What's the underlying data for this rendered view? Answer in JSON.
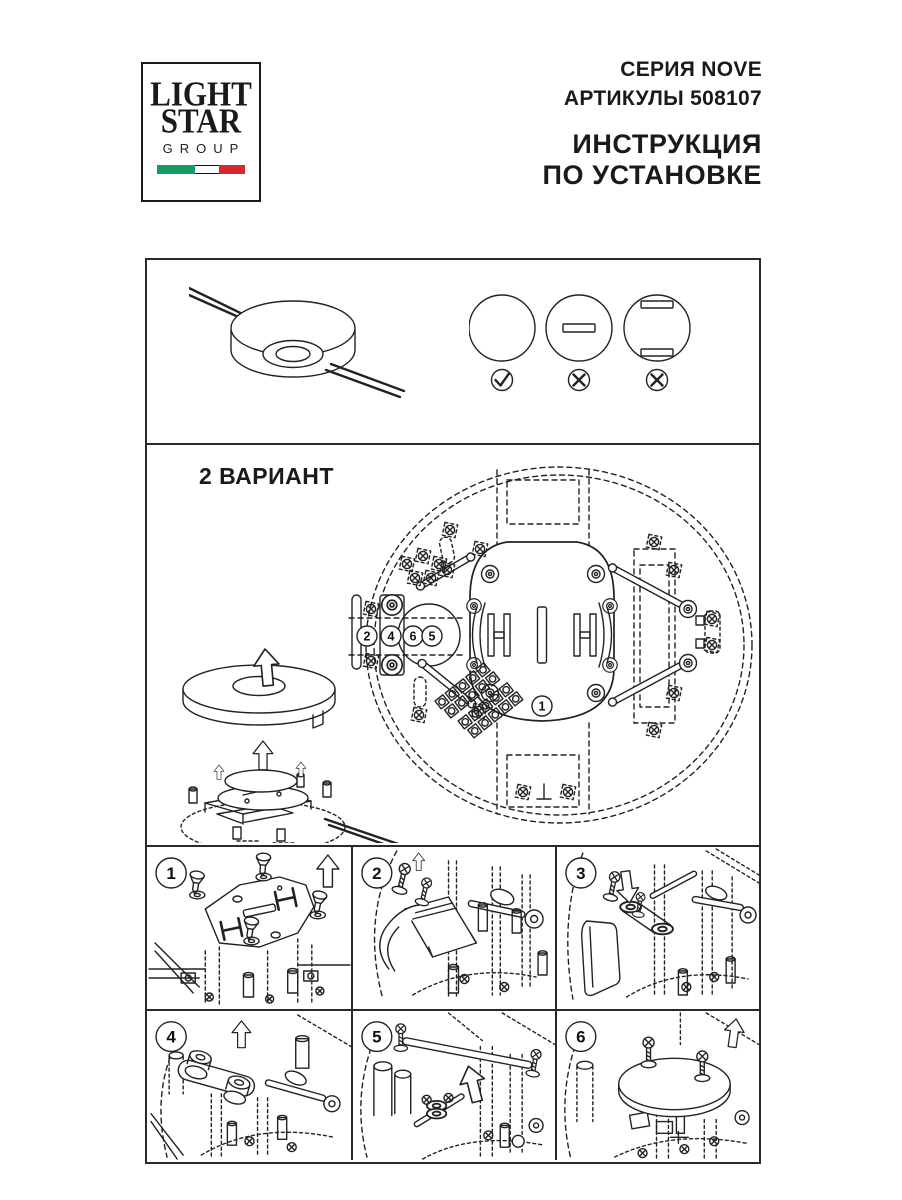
{
  "logo": {
    "line1": "LIGHT",
    "line2": "STAR",
    "line3": "GROUP"
  },
  "header": {
    "series": "СЕРИЯ NOVE",
    "articles": "АРТИКУЛЫ 508107",
    "title_line1": "ИНСТРУКЦИЯ",
    "title_line2": "ПО УСТАНОВКЕ"
  },
  "symbols": {
    "ok_mark": "✓",
    "wrong_mark": "✕"
  },
  "variant": {
    "heading": "2 ВАРИАНТ",
    "callouts": [
      "2",
      "4",
      "6",
      "5"
    ],
    "plate_callout": "1"
  },
  "steps": [
    {
      "number": "1"
    },
    {
      "number": "2"
    },
    {
      "number": "3"
    },
    {
      "number": "4"
    },
    {
      "number": "5"
    },
    {
      "number": "6"
    }
  ],
  "colors": {
    "ink": "#222222",
    "paper": "#ffffff",
    "flag_green": "#169B62",
    "flag_white": "#FFFFFF",
    "flag_red": "#D7282F"
  }
}
